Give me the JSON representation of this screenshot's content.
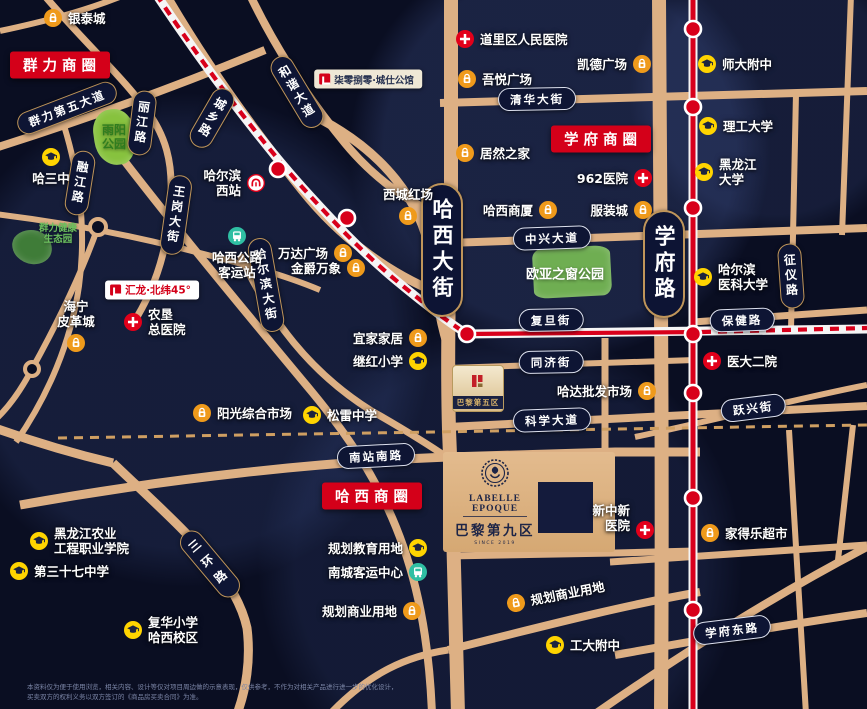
{
  "map": {
    "width": 867,
    "height": 709,
    "colors": {
      "background": "#0a0e22",
      "road": "#ddb084",
      "road_minor": "#cf9f62",
      "rail_red": "#d8001b",
      "rail_white": "#f5f5f5",
      "pill_bg": "#0e1534",
      "pill_border_gold": "#bf955a",
      "pill_border_light": "#dde1ef",
      "banner_red": "#d40019",
      "mall": "#ef9a1b",
      "school": "#ffd400",
      "hospital": "#e2001a",
      "transit": "#2fbfa3",
      "park_green": "#87c23e"
    },
    "banners": [
      {
        "id": "qunli",
        "text": "群力商圈",
        "x": 60,
        "y": 65
      },
      {
        "id": "xuefu",
        "text": "学府商圈",
        "x": 601,
        "y": 139
      },
      {
        "id": "haxi",
        "text": "哈西商圈",
        "x": 372,
        "y": 496
      }
    ],
    "big_pills": [
      {
        "text": "哈西大街",
        "x": 442,
        "y": 250
      },
      {
        "text": "学府路",
        "x": 664,
        "y": 264
      }
    ],
    "street_pills": [
      {
        "text": "群力第五大道",
        "x": 67,
        "y": 108,
        "rot": -21,
        "o": "h",
        "b": "gold"
      },
      {
        "text": "丽江路",
        "x": 142,
        "y": 123,
        "rot": 7,
        "o": "v",
        "b": "gold"
      },
      {
        "text": "城乡路",
        "x": 212,
        "y": 118,
        "rot": 30,
        "o": "v",
        "b": "gold"
      },
      {
        "text": "和谐大道",
        "x": 297,
        "y": 92,
        "rot": -31,
        "o": "v",
        "b": "gold"
      },
      {
        "text": "融江路",
        "x": 80,
        "y": 183,
        "rot": 9,
        "o": "v",
        "b": "gold"
      },
      {
        "text": "王岗大街",
        "x": 176,
        "y": 215,
        "rot": 8,
        "o": "v",
        "b": "gold"
      },
      {
        "text": "哈尔滨大街",
        "x": 266,
        "y": 285,
        "rot": -10,
        "o": "v",
        "b": "gold"
      },
      {
        "text": "三环路",
        "x": 210,
        "y": 564,
        "rot": -40,
        "o": "v",
        "b": "gold",
        "ls": 8
      },
      {
        "text": "征仪路",
        "x": 791,
        "y": 276,
        "rot": -4,
        "o": "v",
        "b": "gold"
      },
      {
        "text": "清华大街",
        "x": 537,
        "y": 99,
        "rot": -1,
        "o": "h",
        "b": "light"
      },
      {
        "text": "中兴大道",
        "x": 552,
        "y": 238,
        "rot": -2,
        "o": "h",
        "b": "light"
      },
      {
        "text": "复旦街",
        "x": 551,
        "y": 320,
        "rot": -1,
        "o": "h",
        "b": "light"
      },
      {
        "text": "同济街",
        "x": 551,
        "y": 362,
        "rot": -1,
        "o": "h",
        "b": "light"
      },
      {
        "text": "科学大道",
        "x": 552,
        "y": 420,
        "rot": -2,
        "o": "h",
        "b": "light"
      },
      {
        "text": "保健路",
        "x": 742,
        "y": 320,
        "rot": -2,
        "o": "h",
        "b": "light"
      },
      {
        "text": "跃兴街",
        "x": 753,
        "y": 408,
        "rot": -7,
        "o": "h",
        "b": "light"
      },
      {
        "text": "南站南路",
        "x": 376,
        "y": 456,
        "rot": -3,
        "o": "h",
        "b": "light"
      },
      {
        "text": "学府东路",
        "x": 732,
        "y": 630,
        "rot": -7,
        "o": "h",
        "b": "light"
      }
    ],
    "pois": [
      {
        "t": "mall",
        "lines": [
          "银泰城"
        ],
        "mx": 53,
        "my": 18
      },
      {
        "t": "hospital",
        "lines": [
          "道里区人民医院"
        ],
        "mx": 465,
        "my": 39
      },
      {
        "t": "mall",
        "lines": [
          "吾悦广场"
        ],
        "mx": 467,
        "my": 79
      },
      {
        "t": "mall",
        "lines": [
          "凯德广场"
        ],
        "mx": 642,
        "my": 64,
        "side": "left"
      },
      {
        "t": "school",
        "lines": [
          "师大附中"
        ],
        "mx": 707,
        "my": 64
      },
      {
        "t": "school",
        "lines": [
          "理工大学"
        ],
        "mx": 708,
        "my": 126
      },
      {
        "t": "mall",
        "lines": [
          "居然之家"
        ],
        "mx": 465,
        "my": 153
      },
      {
        "t": "school",
        "lines": [
          "黑龙江",
          "大学"
        ],
        "mx": 704,
        "my": 172
      },
      {
        "t": "hospital",
        "lines": [
          "962医院"
        ],
        "mx": 643,
        "my": 178,
        "side": "left"
      },
      {
        "t": "mall",
        "lines": [
          "服装城"
        ],
        "mx": 643,
        "my": 210,
        "side": "left"
      },
      {
        "t": "mall",
        "lines": [
          "哈西商厦"
        ],
        "mx": 548,
        "my": 210,
        "side": "left"
      },
      {
        "t": "mall",
        "lines": [
          "西城红场"
        ],
        "mx": 408,
        "my": 216,
        "side": "above"
      },
      {
        "t": "school",
        "lines": [
          "哈三中"
        ],
        "mx": 51,
        "my": 157,
        "side": "below"
      },
      {
        "t": "metro",
        "lines": [
          "哈尔滨",
          "西站"
        ],
        "mx": 256,
        "my": 183,
        "side": "left"
      },
      {
        "t": "transit",
        "lines": [
          "哈西公路",
          "客运站"
        ],
        "mx": 237,
        "my": 236,
        "side": "below"
      },
      {
        "t": "mall",
        "lines": [
          "万达广场"
        ],
        "mx": 343,
        "my": 253,
        "side": "left"
      },
      {
        "t": "mall",
        "lines": [
          "金爵万象"
        ],
        "mx": 356,
        "my": 268,
        "side": "left"
      },
      {
        "t": "school",
        "lines": [
          "哈尔滨",
          "医科大学"
        ],
        "mx": 703,
        "my": 277
      },
      {
        "t": "hospital",
        "lines": [
          "农垦",
          "总医院"
        ],
        "mx": 133,
        "my": 322
      },
      {
        "t": "mall",
        "lines": [
          "海宁",
          "皮革城"
        ],
        "mx": 76,
        "my": 343,
        "side": "above"
      },
      {
        "t": "mall",
        "lines": [
          "宜家家居"
        ],
        "mx": 418,
        "my": 338,
        "side": "left"
      },
      {
        "t": "school",
        "lines": [
          "继红小学"
        ],
        "mx": 418,
        "my": 361,
        "side": "left"
      },
      {
        "t": "mall",
        "lines": [
          "哈达批发市场"
        ],
        "mx": 647,
        "my": 391,
        "side": "left"
      },
      {
        "t": "hospital",
        "lines": [
          "医大二院"
        ],
        "mx": 712,
        "my": 361
      },
      {
        "t": "mall",
        "lines": [
          "阳光综合市场"
        ],
        "mx": 202,
        "my": 413
      },
      {
        "t": "school",
        "lines": [
          "松雷中学"
        ],
        "mx": 312,
        "my": 415
      },
      {
        "t": "school",
        "lines": [
          "规划教育用地"
        ],
        "mx": 418,
        "my": 548,
        "side": "left"
      },
      {
        "t": "transit",
        "lines": [
          "南城客运中心"
        ],
        "mx": 418,
        "my": 572,
        "side": "left"
      },
      {
        "t": "mall",
        "lines": [
          "规划商业用地"
        ],
        "mx": 412,
        "my": 611,
        "side": "left"
      },
      {
        "t": "mall",
        "lines": [
          "规划商业用地"
        ],
        "mx": 516,
        "my": 603,
        "rot": -11
      },
      {
        "t": "school",
        "lines": [
          "工大附中"
        ],
        "mx": 555,
        "my": 645
      },
      {
        "t": "hospital",
        "lines": [
          "新中新",
          "医院"
        ],
        "mx": 645,
        "my": 530,
        "side": "left",
        "dy": -12
      },
      {
        "t": "mall",
        "lines": [
          "家得乐超市"
        ],
        "mx": 710,
        "my": 533
      },
      {
        "t": "school",
        "lines": [
          "黑龙江农业",
          "工程职业学院"
        ],
        "mx": 39,
        "my": 541
      },
      {
        "t": "school",
        "lines": [
          "第三十七中学"
        ],
        "mx": 19,
        "my": 571
      },
      {
        "t": "school",
        "lines": [
          "复华小学",
          "哈西校区"
        ],
        "mx": 133,
        "my": 630
      }
    ],
    "parks": [
      {
        "id": "yuyang",
        "lines": [
          "雨阳",
          "公园"
        ],
        "lc": "#2f7d1f",
        "lx": 114,
        "ly": 138,
        "fs": 12,
        "blob": {
          "x": 94,
          "y": 109,
          "w": 42,
          "h": 56,
          "fill": "#87c23e",
          "br": "48% 52% 45% 55%/42% 50% 58% 50%",
          "rot": -8
        }
      },
      {
        "id": "eco",
        "lines": [
          "群力健康",
          "生态园"
        ],
        "lc": "#6cc05e",
        "lx": 58,
        "ly": 235,
        "fs": 9.5,
        "blob": {
          "x": 12,
          "y": 230,
          "w": 40,
          "h": 34,
          "fill": "#3f7c38",
          "br": "50% 50% 45% 55%/45% 55% 45% 55%",
          "rot": 6
        }
      },
      {
        "id": "ouya",
        "lines": [
          "欧亚之窗公园"
        ],
        "lc": "#ffffff",
        "lx": 565,
        "ly": 276,
        "fs": 13,
        "blob": {
          "x": 533,
          "y": 247,
          "w": 78,
          "h": 50,
          "fill": "#6fae52",
          "br": "14% 20% 12% 18%/20% 16% 22% 14%",
          "rot": -3
        }
      }
    ],
    "roads": [
      {
        "d": "M-5,148 C90,118 180,85 265,50",
        "w": 8
      },
      {
        "d": "M0,31 C42,22 82,12 122,-4",
        "w": 6
      },
      {
        "d": "M44,-5 C82,40 122,76 148,112 C166,137 172,162 171,192 C170,240 158,285 132,325",
        "w": 7
      },
      {
        "d": "M166,-5 C205,62 252,128 302,190 C342,240 392,276 448,297",
        "w": 9
      },
      {
        "d": "M250,-5 C274,45 306,95 340,137 C372,178 412,206 450,219",
        "w": 8
      },
      {
        "d": "M103,133 C165,215 237,302 312,392 C382,477 426,560 432,714",
        "w": 8
      },
      {
        "d": "M60,113 C79,170 87,226 79,286 C71,342 48,396 16,442",
        "w": 6
      },
      {
        "d": "M-5,214 C60,222 120,233 180,248 C240,263 282,274 320,290",
        "w": 6
      },
      {
        "d": "M98,227 C82,272 58,322 32,369 C20,392 8,408 -5,420",
        "w": 6
      },
      {
        "d": "M-5,428 C40,444 75,454 113,463",
        "w": 9
      },
      {
        "d": "M113,463 C180,527 235,573 247,628 C251,660 246,690 237,714",
        "w": 9
      },
      {
        "d": "M322,120 C382,152 422,200 431,258 C436,292 440,325 450,352",
        "w": 9
      },
      {
        "d": "M240,255 C270,320 310,372 370,410 C412,434 432,447 448,458",
        "w": 7
      },
      {
        "d": "M20,505 C170,478 320,462 448,457 L615,452 L700,452",
        "w": 9
      },
      {
        "d": "M330,714 C370,672 408,656 448,650",
        "w": 7
      },
      {
        "d": "M451,-5 L451,195 C449,280 447,360 449,430 L453,530 L458,714",
        "w": 14
      },
      {
        "d": "M659,-5 C660,200 663,430 661,714",
        "w": 14
      },
      {
        "d": "M440,103 L867,91",
        "w": 8
      },
      {
        "d": "M448,243 L867,228",
        "w": 8
      },
      {
        "d": "M448,368 L695,360",
        "w": 6
      },
      {
        "d": "M448,427 L867,406",
        "w": 8
      },
      {
        "d": "M693,322 L867,310",
        "w": 7
      },
      {
        "d": "M635,437 C720,419 800,398 867,385",
        "w": 6
      },
      {
        "d": "M615,655 C700,640 790,624 867,613",
        "w": 8
      },
      {
        "d": "M610,562 L867,545",
        "w": 7
      },
      {
        "d": "M595,714 C680,655 775,595 867,547",
        "w": 8
      },
      {
        "d": "M796,93 L791,330",
        "w": 6
      },
      {
        "d": "M789,430 C795,520 800,620 806,714",
        "w": 6
      },
      {
        "d": "M851,-5 L842,235",
        "w": 6
      },
      {
        "d": "M853,425 L838,560",
        "w": 6
      },
      {
        "d": "M605,338 L605,452",
        "w": 7
      },
      {
        "d": "M448,556 L615,553 L695,551",
        "w": 7
      },
      {
        "d": "M448,650 C540,627 620,606 700,592",
        "w": 8
      }
    ],
    "dashed_road": {
      "d": "M58,438 L867,425",
      "w": 3,
      "dash": "9,7"
    },
    "roundabouts": [
      {
        "x": 98,
        "y": 227,
        "r": 8
      },
      {
        "x": 32,
        "y": 369,
        "r": 7
      }
    ],
    "railway": {
      "band": [
        "M156,-6 C210,75 262,142 302,187 C332,220 358,248 392,277 C422,302 448,322 467,334",
        "M467,334 L867,329"
      ],
      "dash": [
        "M156,-6 C210,75 262,142 302,187 C332,220 358,248 392,277 C422,302 448,322 467,334",
        "M702,332 L867,328"
      ],
      "solid": [
        "M467,334 L702,332"
      ],
      "stations": [
        [
          278,
          169
        ],
        [
          347,
          218
        ],
        [
          467,
          334
        ]
      ]
    },
    "metro": {
      "d": "M693,-6 L693,714",
      "stations": [
        [
          693,
          29
        ],
        [
          693,
          107
        ],
        [
          693,
          208
        ],
        [
          693,
          334
        ],
        [
          693,
          393
        ],
        [
          693,
          498
        ],
        [
          693,
          610
        ]
      ]
    },
    "project": {
      "name_en": "LABELLE EPOQUE",
      "name_cn": "巴黎第九区",
      "since": "SINCE 2019"
    },
    "brand_labels": {
      "paris5": "巴黎第五区",
      "qiling": "柒零捌零·城仕公馆",
      "huilong": "汇龙·北纬45°"
    },
    "disclaimer": [
      "本资料仅为便于使用浏览，相关内容、设计等仅对项目周边做的示意表现，仅供参考，不作为对相关产品进行进一步的优化设计，",
      "买卖双方的权利义务以双方签订的《商品房买卖合同》为准。"
    ]
  }
}
